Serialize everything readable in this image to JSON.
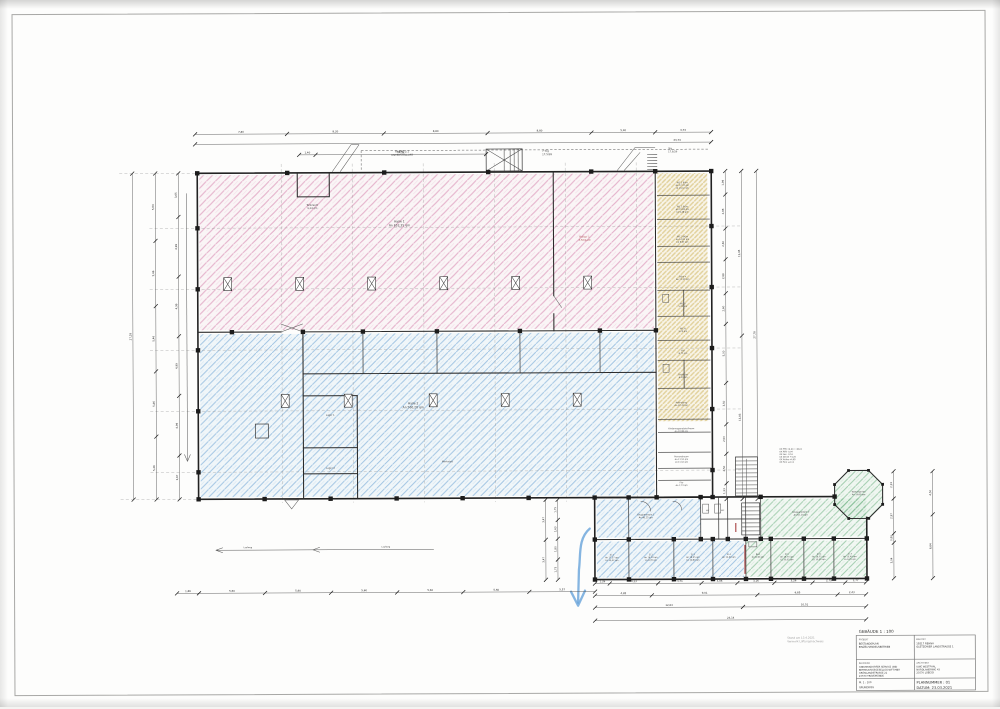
{
  "titleblock": {
    "header": "GEBÄUDE 1 : 100",
    "projekt_label": "PROJEKT",
    "projekt_lines": [
      "BESTANDSPLAN",
      "EINZELHANDELSBETRIEB"
    ],
    "bauort_label": "BAUORT",
    "bauort_lines": [
      "19217 REHNA",
      "GLETZOWER LANDSTRASSE 1"
    ],
    "bauherr_label": "BAUHERR",
    "bauherr_lines": [
      "GNEVERSDORFER SERVICE UND",
      "BETREUUNGSGESELLSCHAFT MBH",
      "GRÖNLANDSTRASSE 21",
      "23570 TRAVEMÜNDE"
    ],
    "architekt_label": "ARCHITEKT",
    "architekt_lines": [
      "UWE WESTPHAL",
      "NORDLANDRING 43",
      "23570 LÜBECK"
    ],
    "massstab": "M. 1 : 100",
    "plantyp": "GRUNDRISS",
    "plannummer": "PLANNUMMER : 01",
    "datum": "DATUM: 23.03.2021"
  },
  "stamp_lines": [
    "Stand am 13.4.2021",
    "Vermerk Lüftungsnachweis"
  ],
  "colors": {
    "hatch_pink": "#d687b0",
    "hatch_blue": "#5f9bd0",
    "hatch_yellow": "#d9c47e",
    "hatch_green": "#6fb383",
    "wall": "#222222",
    "dimension": "#555555",
    "red_mark": "#a84444",
    "hand_arrow_blue": "#66a3d9"
  },
  "dims": {
    "t1": [
      "7,80",
      "8,20",
      "8,80",
      "8,80",
      "5,40",
      "4,74"
    ],
    "t2": [
      "43,74"
    ],
    "t3": [
      "1,40",
      "14,52"
    ],
    "l1": [
      "27,28"
    ],
    "l2": [
      "5,64",
      "5,46",
      "5,46",
      "5,46",
      "5,26"
    ],
    "l3": [
      "3,65",
      "4,99",
      "4,99",
      "4,99",
      "4,99",
      "3,67"
    ],
    "r1": [
      "1,99",
      "2,88",
      "2,60",
      "2,88",
      "2,60",
      "5,00",
      "3,50",
      "2,50",
      "2,50",
      "1,33"
    ],
    "r2": [
      "13,95",
      "13,83"
    ],
    "r3": [
      "27,78"
    ],
    "w1": [
      "2,33",
      "2,97",
      "0,80",
      "3,04"
    ],
    "w2": [
      "4,50",
      "6,64"
    ],
    "lw1": [
      "3,47",
      "3,47"
    ],
    "lw2": [
      "1,75",
      "1,63",
      "1,80",
      "1,75"
    ],
    "b0": [
      "1,86",
      "5,60",
      "5,60",
      "5,60",
      "5,60",
      "5,60",
      "5,57"
    ],
    "wb1": [
      "1,26",
      "4,13",
      "3,71",
      "3,06",
      "3,16",
      "3,26",
      "2,79",
      "1,77"
    ],
    "wb2": [
      "4,85",
      "9,01",
      "6,85",
      "2,43"
    ],
    "wb3": [
      "12,63",
      "10,51"
    ],
    "wb4": [
      "23,14"
    ]
  },
  "room_labels": [
    {
      "x": 403,
      "y": 152,
      "fs": 2.6,
      "lines": [
        "RAMPE 2:1",
        "UNTERSTELLORT"
      ]
    },
    {
      "x": 543,
      "y": 152,
      "fs": 2.6,
      "align": "start",
      "lines": [
        "7 Stg",
        "17,5/28"
      ]
    },
    {
      "x": 669,
      "y": 150,
      "fs": 2.4,
      "align": "start",
      "lines": [
        "Stg",
        "17,8/26"
      ]
    },
    {
      "x": 313,
      "y": 205,
      "fs": 2.4,
      "lines": [
        "Tankraum",
        "9,34 qm"
      ]
    },
    {
      "x": 400,
      "y": 222,
      "fs": 3.0,
      "lines": [
        "Halle 1",
        "An 652,35 qm"
      ]
    },
    {
      "x": 585,
      "y": 238,
      "fs": 2.5,
      "color": "#b05555",
      "lines": [
        "Rolltor 1",
        "3,50/4,20"
      ]
    },
    {
      "x": 413,
      "y": 404,
      "fs": 3.0,
      "lines": [
        "Halle 2",
        "An 560,20 qm"
      ]
    },
    {
      "x": 330,
      "y": 415,
      "fs": 2.3,
      "lines": [
        "Lager 1"
      ]
    },
    {
      "x": 330,
      "y": 468,
      "fs": 2.3,
      "lines": [
        "Lager 2"
      ]
    },
    {
      "x": 447,
      "y": 462,
      "fs": 2.3,
      "lines": [
        "Werkstatt"
      ]
    },
    {
      "x": 683,
      "y": 184,
      "fs": 2.1,
      "lines": [
        "WC 1 Büro",
        "An 17,37 qm",
        "Lü 10,42 qm"
      ]
    },
    {
      "x": 683,
      "y": 208,
      "fs": 2.1,
      "lines": [
        "WC 2 Büro",
        "An 15,80 qm",
        "Lü 9,48 qm"
      ]
    },
    {
      "x": 683,
      "y": 238,
      "fs": 2.1,
      "lines": [
        "WC 3 Büro",
        "An 14,92 qm",
        "Lü 8,95 qm"
      ]
    },
    {
      "x": 683,
      "y": 278,
      "fs": 2.1,
      "lines": [
        "Büro 4",
        "An 12,40 qm"
      ]
    },
    {
      "x": 683,
      "y": 305,
      "fs": 2.1,
      "lines": [
        "WC D",
        "5,20 qm"
      ]
    },
    {
      "x": 683,
      "y": 330,
      "fs": 2.1,
      "lines": [
        "WC H",
        "5,20 qm"
      ]
    },
    {
      "x": 683,
      "y": 352,
      "fs": 2.1,
      "lines": [
        "Flur",
        "8,75 qm"
      ]
    },
    {
      "x": 683,
      "y": 376,
      "fs": 2.1,
      "lines": [
        "Teeküche",
        "6,40 qm"
      ]
    },
    {
      "x": 681,
      "y": 404,
      "fs": 2.1,
      "lines": [
        "Anbindung",
        "An 12,45 qm"
      ]
    },
    {
      "x": 681,
      "y": 430,
      "fs": 2.1,
      "lines": [
        "Kinderwagenabstellraum",
        "An 10,98 qm"
      ]
    },
    {
      "x": 681,
      "y": 458,
      "fs": 2.1,
      "lines": [
        "Personalraum",
        "An 11,52 qm",
        "Lü 11,52 qm"
      ]
    },
    {
      "x": 681,
      "y": 484,
      "fs": 2.1,
      "lines": [
        "Flur",
        "An 7,73 qm"
      ]
    },
    {
      "x": 645,
      "y": 516,
      "fs": 2.2,
      "lines": [
        "Gruppenraum 1",
        "An 46,25 qm"
      ]
    },
    {
      "x": 800,
      "y": 514,
      "fs": 2.2,
      "lines": [
        "Gruppenraum 2",
        "An 52,10 qm"
      ]
    },
    {
      "x": 858,
      "y": 494,
      "fs": 2.1,
      "lines": [
        "Wintergarten",
        "An 14,60 qm"
      ]
    },
    {
      "x": 707,
      "y": 512,
      "fs": 1.9,
      "lines": [
        "WC"
      ]
    },
    {
      "x": 722,
      "y": 512,
      "fs": 1.9,
      "lines": [
        "WC"
      ]
    },
    {
      "x": 611,
      "y": 556,
      "fs": 2.1,
      "lines": [
        "Zi 1",
        "An 17,37 qm",
        "Lü 10,42 qm"
      ]
    },
    {
      "x": 650,
      "y": 556,
      "fs": 2.1,
      "lines": [
        "Zi 2",
        "An 16,20 qm",
        "Lü 9,70 qm"
      ]
    },
    {
      "x": 692,
      "y": 556,
      "fs": 2.1,
      "lines": [
        "Zi 3",
        "An 18,05 qm",
        "Lü 10,80 qm"
      ]
    },
    {
      "x": 728,
      "y": 556,
      "fs": 2.1,
      "lines": [
        "Zi 4",
        "An 14,90 qm"
      ]
    },
    {
      "x": 757,
      "y": 556,
      "fs": 2.1,
      "lines": [
        "Bad",
        "An 8,40 qm"
      ]
    },
    {
      "x": 786,
      "y": 556,
      "fs": 2.1,
      "lines": [
        "Zi 5",
        "An 16,75 qm",
        "Lü 10,05 qm"
      ]
    },
    {
      "x": 818,
      "y": 556,
      "fs": 2.1,
      "lines": [
        "Zi 6",
        "An 16,75 qm",
        "Lü 10,05 qm"
      ]
    },
    {
      "x": 849,
      "y": 556,
      "fs": 2.1,
      "lines": [
        "Zi 7",
        "An 15,40 qm",
        "Lü 9,25 qm"
      ]
    },
    {
      "x": 779,
      "y": 451,
      "fs": 2.0,
      "align": "start",
      "color": "#444444",
      "lines": [
        "OK FFB ±0,00 = 48,01",
        "OK RFB  -0,04",
        "OK Gel.  -0,16",
        "UK Decke +3,26",
        "OK Attika +4,85",
        "OK First +6,12"
      ]
    },
    {
      "x": 247,
      "y": 547,
      "fs": 2.1,
      "lines": [
        "Laufweg"
      ]
    },
    {
      "x": 385,
      "y": 547,
      "fs": 2.1,
      "lines": [
        "Laufweg"
      ]
    }
  ]
}
